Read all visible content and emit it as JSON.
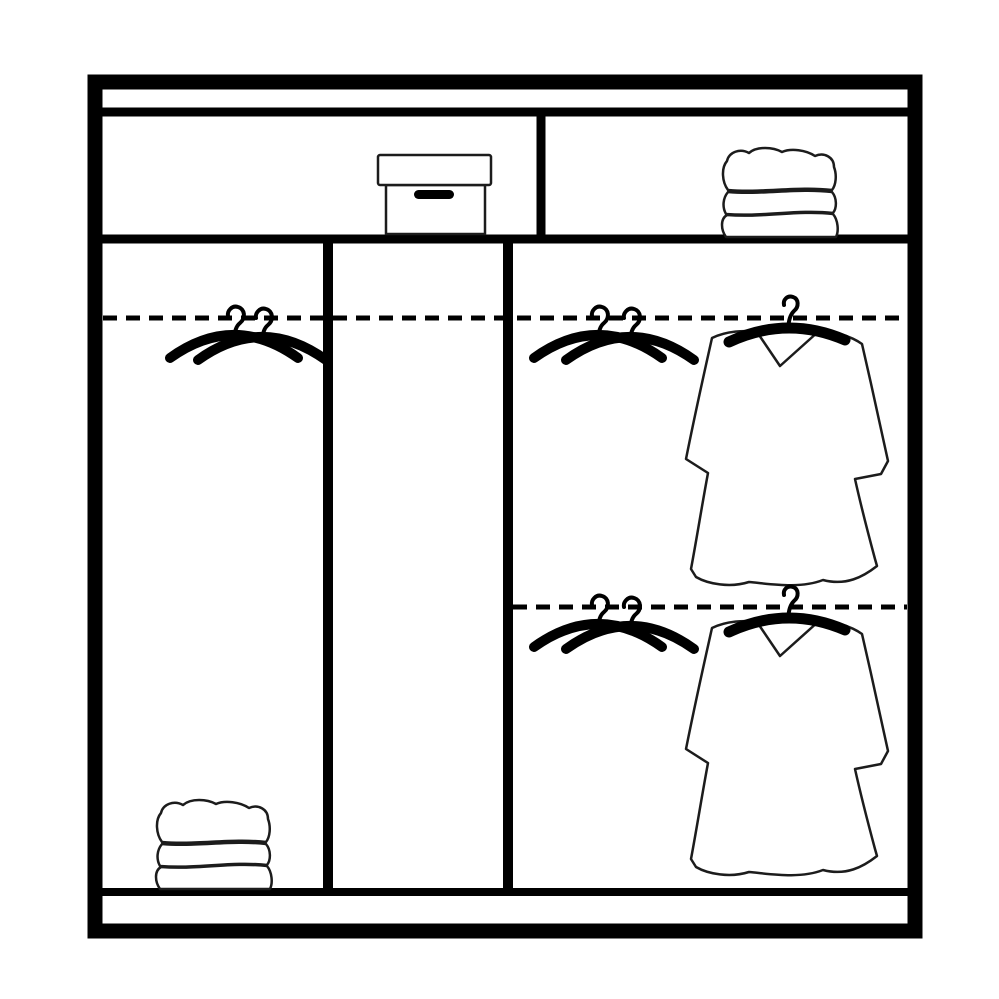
{
  "title": "Wardrobe interior storage layout diagram",
  "colors": {
    "background": "#ffffff",
    "frame": "#000000",
    "outline": "#1c1c1c",
    "fill": "#ffffff"
  },
  "wardrobe": {
    "top_shelf": {
      "left_compartment": {
        "item": "storage-box-with-lid-and-handle"
      },
      "right_compartment": {
        "item": "folded-linen-stack",
        "layers": 3
      }
    },
    "sections": [
      {
        "name": "left-hanging-section",
        "rails": 1,
        "rail_style": "dashed",
        "hangers": 2,
        "garments": 0,
        "floor_item": "folded-linen-stack"
      },
      {
        "name": "middle-empty-section",
        "rails": 1,
        "rail_style": "dashed",
        "hangers": 0,
        "garments": 0,
        "floor_item": null
      },
      {
        "name": "right-double-hang-section",
        "rails": 2,
        "rail_style": "dashed",
        "hangers_per_rail": 2,
        "garments_per_rail": 1,
        "garment_type": "long-sleeve-tunic-on-hanger"
      }
    ],
    "base": "plinth-strip"
  }
}
